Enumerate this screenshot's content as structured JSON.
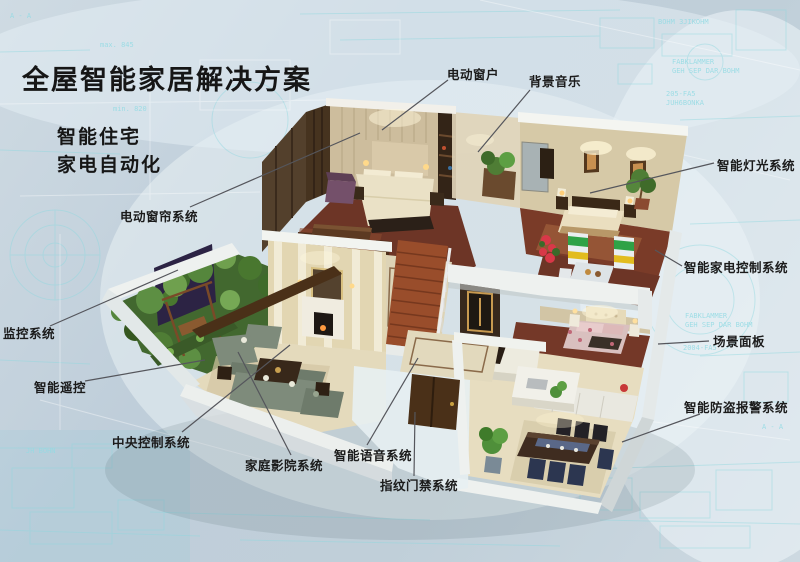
{
  "header": {
    "title": "全屋智能家居解决方案",
    "subtitle1": "智能住宅",
    "subtitle2": "家电自动化"
  },
  "callouts": [
    {
      "id": "electric-window",
      "text": "电动窗户"
    },
    {
      "id": "background-music",
      "text": "背景音乐"
    },
    {
      "id": "smart-lighting",
      "text": "智能灯光系统"
    },
    {
      "id": "smart-appliance-control",
      "text": "智能家电控制系统"
    },
    {
      "id": "scene-panel",
      "text": "场景面板"
    },
    {
      "id": "burglar-alarm",
      "text": "智能防盗报警系统"
    },
    {
      "id": "electric-curtain",
      "text": "电动窗帘系统"
    },
    {
      "id": "monitoring",
      "text": "监控系统"
    },
    {
      "id": "smart-remote",
      "text": "智能遥控"
    },
    {
      "id": "central-control",
      "text": "中央控制系统"
    },
    {
      "id": "home-theater",
      "text": "家庭影院系统"
    },
    {
      "id": "smart-voice",
      "text": "智能语音系统"
    },
    {
      "id": "fingerprint-access",
      "text": "指纹门禁系统"
    }
  ],
  "bg": {
    "texts": [
      {
        "t": "max. 845"
      },
      {
        "t": "min. 820"
      },
      {
        "t": "BOHM 3JIKOHM"
      },
      {
        "t": "FABKLAMMER"
      },
      {
        "t": "GEH SEP DAR BOHM"
      },
      {
        "t": "205-FA5"
      },
      {
        "t": "JUH6BONKA"
      },
      {
        "t": "FABKLAMMER"
      },
      {
        "t": "GEH SEP DAR BOHM"
      },
      {
        "t": "2004-FA5"
      },
      {
        "t": "A - A"
      },
      {
        "t": "JH BOHN"
      },
      {
        "t": "A - A"
      }
    ]
  },
  "colors": {
    "background": "#c3d2dc",
    "blueprint_cyan": "#8fd8df",
    "label_text": "#1b1b1b",
    "leader_line": "#55565c",
    "wall_white": "#eef1ef",
    "wall_cream": "#e2d6b2",
    "wood_dark": "#3a2a1c",
    "floor_wood_red": "#6d3526",
    "floor_marble": "#e6dcc0",
    "plant_green": "#4f7d3a",
    "appliance_green": "#2fa246",
    "appliance_yellow": "#e2bc1e"
  }
}
